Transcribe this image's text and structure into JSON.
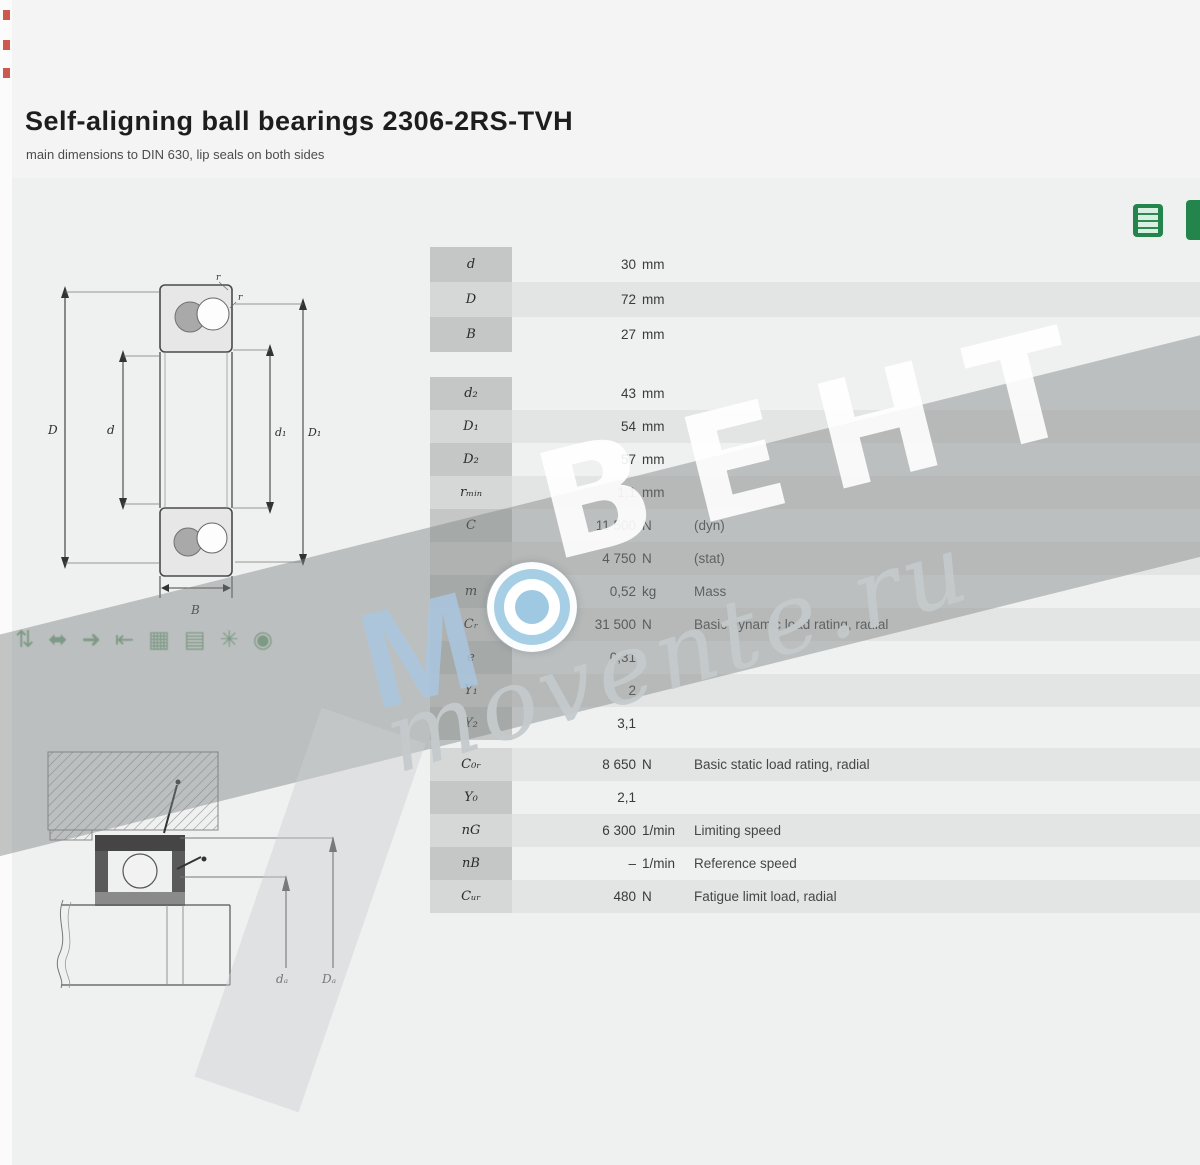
{
  "page": {
    "title": "Self-aligning ball bearings 2306-2RS-TVH",
    "subtitle": "main dimensions to DIN 630, lip seals on both sides"
  },
  "watermark": {
    "letters": "ВЕНТ",
    "m_letter": "М",
    "script": "movente.ru"
  },
  "feature_icons": {
    "glyphs": [
      "⇅",
      "⬌",
      "➜",
      "⇤",
      "▦",
      "▤",
      "✳",
      "◉"
    ]
  },
  "drawing1_labels": {
    "D": "D",
    "d": "d",
    "d1": "d₁",
    "D1": "D₁",
    "B": "B",
    "r_top": "r",
    "r_side": "r"
  },
  "drawing2_labels": {
    "da": "dₐ",
    "Da": "Dₐ"
  },
  "colors": {
    "accent_green": "#23854b",
    "stripe": "#e3e5e4",
    "label_column": "#c5c7c6"
  },
  "table": {
    "blocks": [
      {
        "rows": [
          {
            "sym": "d",
            "val": "30",
            "unit": "mm",
            "desc": ""
          },
          {
            "sym": "D",
            "val": "72",
            "unit": "mm",
            "desc": ""
          },
          {
            "sym": "B",
            "val": "27",
            "unit": "mm",
            "desc": ""
          }
        ]
      },
      {
        "rows": [
          {
            "sym": "d₂",
            "val": "43",
            "unit": "mm",
            "desc": ""
          },
          {
            "sym": "D₁",
            "val": "54",
            "unit": "mm",
            "desc": ""
          },
          {
            "sym": "D₂",
            "val": "57",
            "unit": "mm",
            "desc": ""
          },
          {
            "sym": "rₘᵢₙ",
            "val": "1,1",
            "unit": "mm",
            "desc": ""
          },
          {
            "sym": "C",
            "val": "11 500",
            "unit": "N",
            "desc": "(dyn)"
          },
          {
            "sym": "",
            "val": "4 750",
            "unit": "N",
            "desc": "(stat)"
          }
        ]
      },
      {
        "rows": [
          {
            "sym": "m",
            "val": "0,52",
            "unit": "kg",
            "desc": "Mass"
          },
          {
            "sym": "Cᵣ",
            "val": "31 500",
            "unit": "N",
            "desc": "Basic dynamic load rating, radial"
          },
          {
            "sym": "e",
            "val": "0,31",
            "unit": "",
            "desc": ""
          },
          {
            "sym": "Y₁",
            "val": "2",
            "unit": "",
            "desc": ""
          },
          {
            "sym": "Y₂",
            "val": "3,1",
            "unit": "",
            "desc": ""
          }
        ]
      },
      {
        "rows": [
          {
            "sym": "C₀ᵣ",
            "val": "8 650",
            "unit": "N",
            "desc": "Basic static load rating, radial"
          },
          {
            "sym": "Y₀",
            "val": "2,1",
            "unit": "",
            "desc": ""
          },
          {
            "sym": "nG",
            "val": "6 300",
            "unit": "1/min",
            "desc": "Limiting speed"
          },
          {
            "sym": "nB",
            "val": "–",
            "unit": "1/min",
            "desc": "Reference speed"
          },
          {
            "sym": "Cᵤᵣ",
            "val": "480",
            "unit": "N",
            "desc": "Fatigue limit load, radial"
          }
        ]
      }
    ]
  }
}
